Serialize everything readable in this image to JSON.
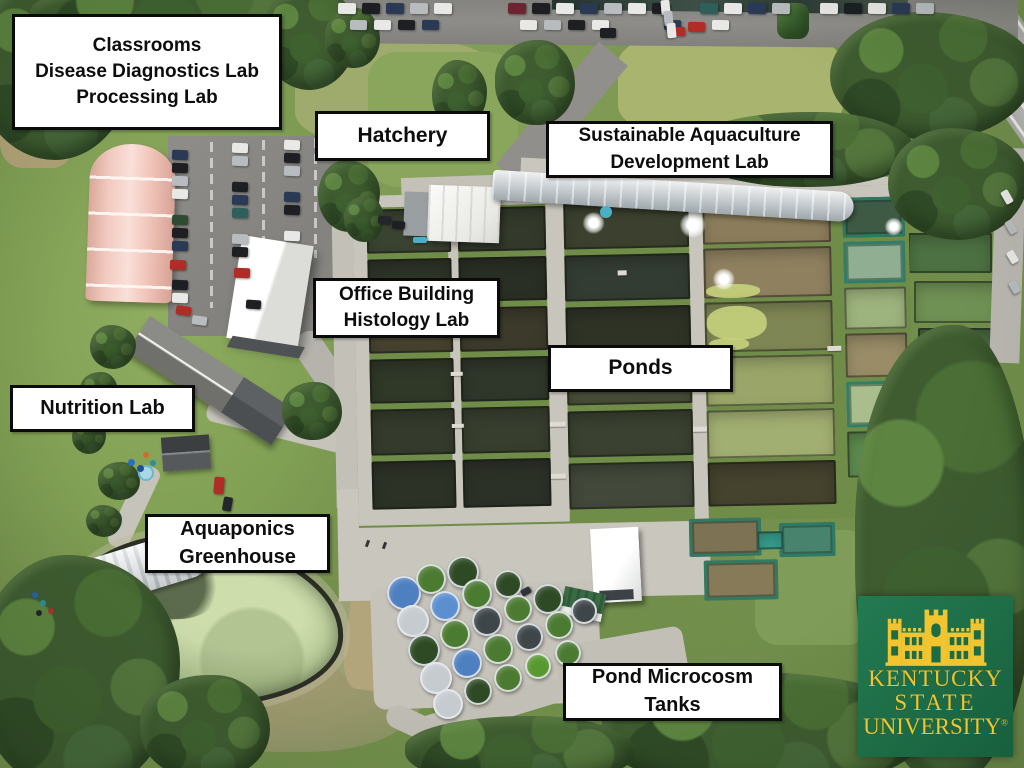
{
  "labels": [
    {
      "id": "classrooms",
      "text": "Classrooms\nDisease Diagnostics Lab\nProcessing Lab"
    },
    {
      "id": "hatchery",
      "text": "Hatchery"
    },
    {
      "id": "sustainable",
      "text": "Sustainable Aquaculture\nDevelopment Lab"
    },
    {
      "id": "office",
      "text": "Office Building\nHistology Lab"
    },
    {
      "id": "ponds",
      "text": "Ponds"
    },
    {
      "id": "nutrition",
      "text": "Nutrition Lab"
    },
    {
      "id": "aquaponics",
      "text": "Aquaponics\nGreenhouse"
    },
    {
      "id": "microcosm",
      "text": "Pond Microcosm\nTanks"
    }
  ],
  "logo": {
    "line1": "KENTUCKY",
    "line2": "STATE",
    "line3": "UNIVERSITY",
    "registered": "®",
    "background_color": "#1e6f4a",
    "gold_color": "#f1c52f"
  },
  "palette": {
    "label_background": "#ffffff",
    "label_border": "#0b0b0b",
    "label_text": "#0d0d0d"
  },
  "scene": {
    "trees": [
      [
        -25,
        -25,
        160,
        185
      ],
      [
        30,
        -20,
        300,
        70
      ],
      [
        262,
        -15,
        95,
        105
      ],
      [
        325,
        8,
        55,
        60
      ],
      [
        432,
        60,
        55,
        70
      ],
      [
        495,
        40,
        80,
        85
      ],
      [
        830,
        12,
        205,
        128
      ],
      [
        690,
        112,
        225,
        75
      ],
      [
        888,
        128,
        140,
        112
      ],
      [
        855,
        325,
        180,
        460
      ],
      [
        600,
        672,
        330,
        120
      ],
      [
        405,
        716,
        230,
        70
      ],
      [
        -25,
        555,
        205,
        240
      ],
      [
        140,
        675,
        130,
        105
      ],
      [
        90,
        325,
        46,
        44
      ],
      [
        80,
        372,
        38,
        38
      ],
      [
        72,
        420,
        34,
        34
      ],
      [
        98,
        462,
        42,
        38
      ],
      [
        86,
        505,
        36,
        32
      ],
      [
        282,
        382,
        60,
        58
      ],
      [
        318,
        160,
        62,
        72
      ],
      [
        344,
        196,
        40,
        46
      ]
    ],
    "lanes": [
      [
        0,
        0,
        556,
        12
      ],
      [
        0,
        12,
        14,
        310
      ],
      [
        95,
        12,
        10,
        310
      ],
      [
        193,
        12,
        18,
        310
      ],
      [
        336,
        12,
        14,
        322
      ],
      [
        0,
        314,
        211,
        16
      ]
    ],
    "ponds": [
      [
        14,
        14,
        84,
        44,
        "#3a4231",
        0
      ],
      [
        14,
        64,
        84,
        44,
        "#2e3328",
        0
      ],
      [
        14,
        114,
        84,
        44,
        "#46412f",
        0
      ],
      [
        14,
        164,
        84,
        44,
        "#303828",
        0
      ],
      [
        14,
        214,
        84,
        46,
        "#343b2c",
        0
      ],
      [
        14,
        266,
        84,
        48,
        "#2d3227",
        0
      ],
      [
        105,
        14,
        88,
        44,
        "#333a2b",
        0
      ],
      [
        105,
        64,
        88,
        44,
        "#2a2f25",
        0
      ],
      [
        105,
        114,
        88,
        44,
        "#3c3a2b",
        0
      ],
      [
        105,
        164,
        88,
        44,
        "#2f362a",
        0
      ],
      [
        105,
        214,
        88,
        46,
        "#373e2e",
        0
      ],
      [
        105,
        266,
        88,
        48,
        "#2c3128",
        0
      ],
      [
        211,
        12,
        125,
        46,
        "#3b412e",
        0
      ],
      [
        211,
        64,
        125,
        46,
        "#333c32",
        0
      ],
      [
        211,
        116,
        125,
        46,
        "#2f3326",
        0
      ],
      [
        211,
        168,
        125,
        46,
        "#474c36",
        0
      ],
      [
        211,
        220,
        125,
        46,
        "#3a4130",
        0
      ],
      [
        211,
        272,
        125,
        46,
        "#42483a",
        0
      ],
      [
        350,
        12,
        128,
        44,
        "#8b7d5b",
        0
      ],
      [
        350,
        60,
        128,
        50,
        "#8f8160",
        0
      ],
      [
        350,
        114,
        128,
        50,
        "#7f8655",
        0
      ],
      [
        350,
        168,
        128,
        50,
        "#9aa569",
        0
      ],
      [
        350,
        222,
        128,
        48,
        "#a2af72",
        0
      ],
      [
        350,
        274,
        128,
        44,
        "#45422e",
        0
      ],
      [
        490,
        12,
        62,
        40,
        "#3f5a44",
        1
      ],
      [
        490,
        56,
        62,
        42,
        "#8fae92",
        1
      ],
      [
        490,
        102,
        62,
        42,
        "#9eb47e",
        0
      ],
      [
        490,
        148,
        62,
        44,
        "#998c67",
        0
      ],
      [
        490,
        196,
        62,
        46,
        "#a9bd8d",
        1
      ],
      [
        490,
        246,
        62,
        46,
        "#5c8a4e",
        0
      ],
      [
        330,
        330,
        72,
        38,
        "#7d7253",
        1
      ],
      [
        344,
        372,
        74,
        40,
        "#867a58",
        1
      ],
      [
        420,
        336,
        56,
        34,
        "#48836e",
        1
      ],
      [
        398,
        344,
        26,
        18,
        "#38a18e",
        0
      ]
    ],
    "right_ponds": [
      [
        908,
        233,
        84,
        40,
        "#4d7142"
      ],
      [
        914,
        281,
        86,
        42,
        "#6f9154"
      ],
      [
        918,
        328,
        78,
        36,
        "#49693f"
      ]
    ],
    "algae": [
      [
        352,
        96,
        54,
        14
      ],
      [
        352,
        118,
        60,
        34
      ],
      [
        354,
        150,
        40,
        12
      ]
    ],
    "docks": [
      [
        193,
        178,
        16,
        5
      ],
      [
        193,
        230,
        16,
        5
      ],
      [
        193,
        282,
        15,
        5
      ],
      [
        95,
        178,
        12,
        4
      ],
      [
        95,
        230,
        12,
        4
      ],
      [
        264,
        80,
        9,
        5
      ],
      [
        472,
        160,
        14,
        5
      ],
      [
        336,
        186,
        14,
        5
      ],
      [
        336,
        238,
        14,
        5
      ]
    ],
    "fountains": [
      [
        241,
        32,
        22
      ],
      [
        340,
        36,
        26
      ],
      [
        370,
        91,
        22
      ],
      [
        541,
        42,
        18
      ]
    ],
    "tanks": [
      [
        404,
        593,
        34,
        "#4e7fc0"
      ],
      [
        431,
        579,
        30,
        "#4b7a31"
      ],
      [
        463,
        572,
        32,
        "#2e4a25"
      ],
      [
        413,
        621,
        32,
        "#c6cbd0"
      ],
      [
        445,
        606,
        30,
        "#5b8fd0"
      ],
      [
        477,
        594,
        30,
        "#4b7a31"
      ],
      [
        508,
        584,
        28,
        "#2e4a25"
      ],
      [
        424,
        650,
        32,
        "#2e4a25"
      ],
      [
        455,
        634,
        30,
        "#4b7a31"
      ],
      [
        487,
        621,
        30,
        "#3f464a"
      ],
      [
        518,
        609,
        28,
        "#4b7a31"
      ],
      [
        548,
        599,
        30,
        "#2e4a25"
      ],
      [
        436,
        678,
        32,
        "#c6cbd0"
      ],
      [
        467,
        663,
        30,
        "#4e7fc0"
      ],
      [
        498,
        649,
        30,
        "#4b7a31"
      ],
      [
        529,
        637,
        28,
        "#3f464a"
      ],
      [
        559,
        625,
        28,
        "#4b7a31"
      ],
      [
        448,
        704,
        30,
        "#c6cbd0"
      ],
      [
        478,
        691,
        28,
        "#2e4a25"
      ],
      [
        508,
        678,
        28,
        "#4b7a31"
      ],
      [
        538,
        666,
        26,
        "#58992f"
      ],
      [
        568,
        653,
        26,
        "#4b7a31"
      ],
      [
        584,
        611,
        26,
        "#3f464a"
      ]
    ],
    "cars": [
      [
        338,
        3,
        18,
        11,
        1,
        "#e8e8e6"
      ],
      [
        362,
        3,
        18,
        11,
        1,
        "#1d1f22"
      ],
      [
        386,
        3,
        18,
        11,
        1,
        "#2a3a55"
      ],
      [
        410,
        3,
        18,
        11,
        1,
        "#b8bcbf"
      ],
      [
        434,
        3,
        18,
        11,
        1,
        "#e8e8e6"
      ],
      [
        508,
        3,
        18,
        11,
        1,
        "#6e2430"
      ],
      [
        532,
        3,
        18,
        11,
        1,
        "#1d1f22"
      ],
      [
        556,
        3,
        18,
        11,
        1,
        "#e8e8e6"
      ],
      [
        580,
        3,
        18,
        11,
        1,
        "#2a3a55"
      ],
      [
        604,
        3,
        18,
        11,
        1,
        "#b8bcbf"
      ],
      [
        628,
        3,
        18,
        11,
        1,
        "#e8e8e6"
      ],
      [
        652,
        3,
        18,
        11,
        1,
        "#1d1f22"
      ],
      [
        700,
        3,
        18,
        11,
        1,
        "#2e5f5a"
      ],
      [
        724,
        3,
        18,
        11,
        1,
        "#e8e8e6"
      ],
      [
        748,
        3,
        18,
        11,
        1,
        "#2a3a55"
      ],
      [
        772,
        3,
        18,
        11,
        1,
        "#b8bcbf"
      ],
      [
        820,
        3,
        18,
        11,
        1,
        "#e8e8e6"
      ],
      [
        844,
        3,
        18,
        11,
        1,
        "#1d1f22"
      ],
      [
        868,
        3,
        18,
        11,
        1,
        "#e8e8e6"
      ],
      [
        892,
        3,
        18,
        11,
        1,
        "#2a3a55"
      ],
      [
        916,
        3,
        18,
        11,
        1,
        "#b8bcbf"
      ],
      [
        350,
        20,
        17,
        10,
        1,
        "#b8bcbf"
      ],
      [
        374,
        20,
        17,
        10,
        1,
        "#e8e8e6"
      ],
      [
        398,
        20,
        17,
        10,
        1,
        "#1d1f22"
      ],
      [
        422,
        20,
        17,
        10,
        1,
        "#2a3a55"
      ],
      [
        520,
        20,
        17,
        10,
        1,
        "#e8e8e6"
      ],
      [
        544,
        20,
        17,
        10,
        1,
        "#b8bcbf"
      ],
      [
        568,
        20,
        17,
        10,
        1,
        "#1d1f22"
      ],
      [
        592,
        20,
        17,
        10,
        1,
        "#e8e8e6"
      ],
      [
        664,
        20,
        17,
        10,
        1,
        "#2a3a55"
      ],
      [
        688,
        22,
        17,
        10,
        1,
        "#b02c26"
      ],
      [
        712,
        20,
        17,
        10,
        1,
        "#e8e8e6"
      ],
      [
        600,
        28,
        16,
        10,
        0,
        "#1d1f22"
      ],
      [
        670,
        27,
        15,
        9,
        0,
        "#b02c26"
      ],
      [
        658,
        3,
        15,
        9,
        85,
        "#e8e8e6"
      ],
      [
        661,
        14,
        15,
        9,
        85,
        "#b8bcbf"
      ],
      [
        664,
        26,
        15,
        9,
        85,
        "#e8e8e6"
      ],
      [
        172,
        150,
        16,
        10,
        2,
        "#2a3a55"
      ],
      [
        172,
        163,
        16,
        10,
        2,
        "#1d1f22"
      ],
      [
        172,
        176,
        16,
        10,
        2,
        "#b8bcbf"
      ],
      [
        172,
        189,
        16,
        10,
        2,
        "#e8e8e6"
      ],
      [
        172,
        215,
        16,
        10,
        2,
        "#2f4a33"
      ],
      [
        172,
        228,
        16,
        10,
        2,
        "#1d1f22"
      ],
      [
        172,
        241,
        16,
        10,
        2,
        "#2a3a55"
      ],
      [
        170,
        260,
        16,
        10,
        2,
        "#b02c26"
      ],
      [
        172,
        280,
        16,
        10,
        2,
        "#1d1f22"
      ],
      [
        172,
        293,
        16,
        10,
        2,
        "#e8e8e6"
      ],
      [
        232,
        143,
        16,
        10,
        2,
        "#e8e8e6"
      ],
      [
        232,
        156,
        16,
        10,
        2,
        "#b8bcbf"
      ],
      [
        232,
        182,
        16,
        10,
        2,
        "#1d1f22"
      ],
      [
        232,
        195,
        16,
        10,
        2,
        "#2a3a55"
      ],
      [
        232,
        208,
        16,
        10,
        2,
        "#2e5f5a"
      ],
      [
        232,
        234,
        16,
        10,
        2,
        "#b8bcbf"
      ],
      [
        232,
        247,
        16,
        10,
        2,
        "#1d1f22"
      ],
      [
        234,
        268,
        16,
        10,
        2,
        "#b02c26"
      ],
      [
        284,
        140,
        16,
        10,
        2,
        "#e8e8e6"
      ],
      [
        284,
        153,
        16,
        10,
        2,
        "#1d1f22"
      ],
      [
        284,
        166,
        16,
        10,
        2,
        "#b8bcbf"
      ],
      [
        284,
        192,
        16,
        10,
        2,
        "#2a3a55"
      ],
      [
        284,
        205,
        16,
        10,
        2,
        "#1d1f22"
      ],
      [
        284,
        231,
        16,
        10,
        2,
        "#e8e8e6"
      ],
      [
        176,
        306,
        15,
        9,
        8,
        "#b02c26"
      ],
      [
        192,
        316,
        15,
        9,
        8,
        "#b8bcbf"
      ],
      [
        246,
        300,
        15,
        9,
        4,
        "#1d1f22"
      ],
      [
        378,
        216,
        13,
        8,
        5,
        "#23262a"
      ],
      [
        392,
        221,
        13,
        8,
        5,
        "#1d1f22"
      ],
      [
        413,
        237,
        14,
        6,
        0,
        "#49b0c6"
      ],
      [
        214,
        477,
        10,
        17,
        5,
        "#b02c26"
      ],
      [
        223,
        497,
        9,
        14,
        10,
        "#23262a"
      ],
      [
        1000,
        193,
        14,
        8,
        60,
        "#e8e8e6"
      ],
      [
        1004,
        223,
        14,
        8,
        60,
        "#b8bcbf"
      ],
      [
        1006,
        253,
        13,
        8,
        60,
        "#e8e8e6"
      ],
      [
        1008,
        283,
        13,
        8,
        60,
        "#b8bcbf"
      ],
      [
        521,
        588,
        10,
        7,
        -30,
        "#30343a"
      ]
    ],
    "people": [
      [
        383,
        542
      ],
      [
        366,
        540
      ]
    ],
    "barrels": [
      [
        128,
        459,
        7,
        "#2a6fbf"
      ],
      [
        137,
        465,
        7,
        "#1d4f92"
      ],
      [
        143,
        452,
        6,
        "#cf6b2d"
      ],
      [
        150,
        460,
        6,
        "#2d8f9e"
      ],
      [
        32,
        592,
        6,
        "#2563ae"
      ],
      [
        40,
        600,
        6,
        "#2d8f9e"
      ],
      [
        48,
        608,
        6,
        "#a8342c"
      ],
      [
        36,
        610,
        6,
        "#23262a"
      ]
    ]
  }
}
